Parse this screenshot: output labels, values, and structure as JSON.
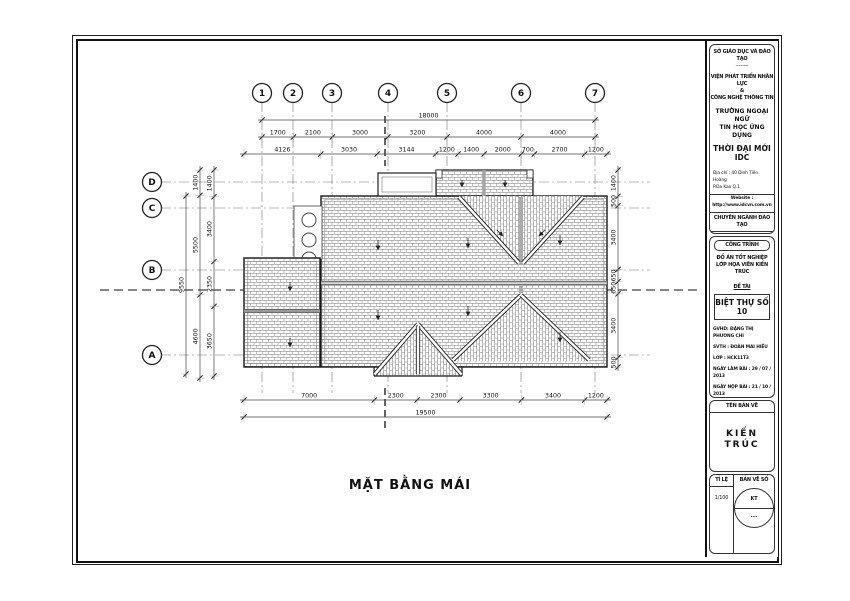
{
  "sheet": {
    "drawing_title": "MẶT BẰNG MÁI",
    "title_block": {
      "department": "SỞ GIÁO DỤC VÀ ĐÀO TẠO",
      "divider": "--------",
      "institute_line1": "VIỆN PHÁT TRIỂN NHÂN LỰC",
      "institute_amp": "&",
      "institute_line2": "CÔNG NGHỆ THÔNG TIN",
      "school_line1": "TRƯỜNG NGOẠI NGỮ",
      "school_line2": "TIN HỌC ỨNG DỤNG",
      "brand": "THỜI ĐẠI MỚI IDC",
      "address_line1": "Địa chỉ : 40 Đinh Tiên Hoàng",
      "address_line2": "P.Đa Kao    Q.1",
      "website": "Website : http://www.idcvn.com.vn",
      "training_header": "CHUYÊN NGÀNH ĐÀO TẠO",
      "major_line1": "HỌA VIÊN",
      "major_line2": "KIẾN TRÚC",
      "project_header": "CÔNG TRÌNH",
      "project_line1": "ĐỒ ÁN TỐT NGHIỆP",
      "project_line2": "LỚP HỌA VIÊN KIẾN TRÚC",
      "topic_label": "ĐỀ TÀI",
      "topic": "BIỆT THỰ SỐ 10",
      "advisor": "GVHD: ĐẶNG THỊ PHƯƠNG CHI",
      "student": "SVTH : ĐOÀN MAI HIẾU",
      "class_line": "LỚP    : HCK11T3",
      "date_assigned": "NGÀY LÀM BÀI    : 29 / 07 / 2013",
      "date_submitted": "NGÀY NỘP BÀI   : 21 / 10 / 2013",
      "sheet_name_header": "TÊN BẢN VẼ",
      "sheet_name": "KIẾN TRÚC",
      "scale_label": "TỈ LỆ",
      "scale_value": "1/100",
      "sheet_no_label": "BẢN VẼ SỐ",
      "sheet_no_top": "KT",
      "sheet_no_bottom": "...."
    }
  },
  "plan": {
    "grid_cols": [
      "1",
      "2",
      "3",
      "4",
      "5",
      "6",
      "7"
    ],
    "grid_rows": [
      "D",
      "C",
      "B",
      "A"
    ],
    "dims": {
      "top_total": "18000",
      "top_spans": [
        "1700",
        "2100",
        "3000",
        "3200",
        "4000",
        "4000"
      ],
      "top_detail": [
        "4126",
        "3030",
        "3144",
        "1200",
        "1400",
        "2000",
        "700",
        "2700",
        "1200"
      ],
      "bottom_spans": [
        "7000",
        "2300",
        "2300",
        "3300",
        "3400",
        "1200"
      ],
      "bottom_total": "19500",
      "left_outer": "9550",
      "left_middle": [
        "1400",
        "5500",
        "4600"
      ],
      "left_inner": [
        "1400",
        "3400",
        "2350",
        "3650"
      ],
      "right_chain": [
        "1400",
        "500",
        "3400",
        "650",
        "650",
        "3400",
        "500"
      ]
    },
    "colors": {
      "line": "#1a1a1a",
      "hatch": "#8f8f8f",
      "dim": "#333333"
    }
  }
}
